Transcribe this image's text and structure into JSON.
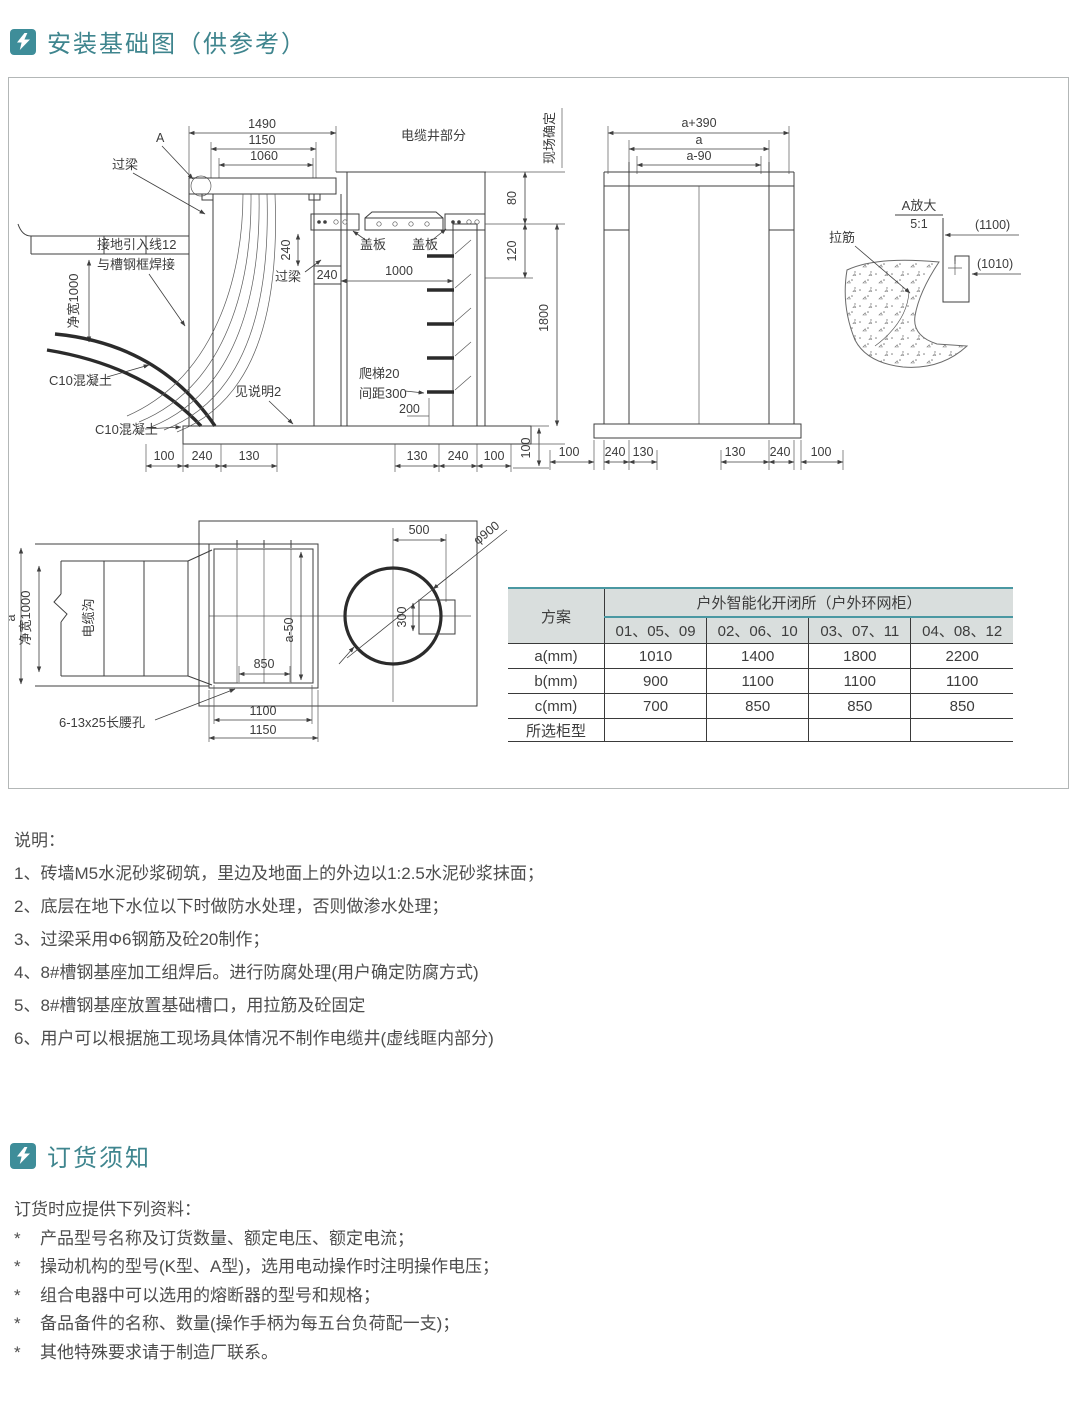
{
  "sections": {
    "install": {
      "title": "安装基础图（供参考）"
    },
    "order": {
      "title": "订货须知"
    }
  },
  "colors": {
    "accent": "#3e8d99",
    "header_text": "#3f858e",
    "table_header_bg": "#d9dedd",
    "table_accent_line": "#4a98a2",
    "drawing_line": "#3f3f3f"
  },
  "drawing": {
    "section": {
      "a": "A",
      "guoliang_top": "过梁",
      "d1490": "1490",
      "d1150": "1150",
      "d1060": "1060",
      "cable_well": "电缆井部分",
      "site_note": "现场确定",
      "d80": "80",
      "d120": "120",
      "d1800": "1800",
      "d100_v": "100",
      "ground_line1": "接地引入线12",
      "ground_line2": "与槽钢框焊接",
      "net_width": "净宽1000",
      "c10_1": "C10混凝土",
      "c10_2": "C10混凝土",
      "see_note2": "见说明2",
      "bottom_left": [
        "100",
        "240",
        "130"
      ],
      "cover1": "盖板",
      "cover2": "盖板",
      "d1000": "1000",
      "d240_v": "240",
      "guoliang_mid": "过梁",
      "d240": "240",
      "ladder1": "爬梯20",
      "ladder2": "间距300",
      "d200": "200",
      "bottom_right": [
        "130",
        "240",
        "100"
      ]
    },
    "front": {
      "a390": "a+390",
      "a": "a",
      "a90": "a-90",
      "bottom": [
        "100",
        "240",
        "130",
        "130",
        "240",
        "100"
      ]
    },
    "detail": {
      "title": "A放大",
      "scale": "5:1",
      "lajin": "拉筋",
      "d1100": "(1100)",
      "d1010": "(1010)"
    },
    "plan": {
      "a": "a",
      "net_width": "净宽1000",
      "trench": "电缆沟",
      "a50": "a-50",
      "d850": "850",
      "d1100": "1100",
      "d1150": "1150",
      "slot": "6-13x25长腰孔",
      "d500": "500",
      "phi900": "φ900",
      "d300": "300"
    }
  },
  "table": {
    "col_plan": "方案",
    "col_group": "户外智能化开闭所（户外环网柜）",
    "subcols": [
      "01、05、09",
      "02、06、10",
      "03、07、11",
      "04、08、12"
    ],
    "rows": [
      {
        "label": "a(mm)",
        "values": [
          "1010",
          "1400",
          "1800",
          "2200"
        ]
      },
      {
        "label": "b(mm)",
        "values": [
          "900",
          "1100",
          "1100",
          "1100"
        ]
      },
      {
        "label": "c(mm)",
        "values": [
          "700",
          "850",
          "850",
          "850"
        ]
      },
      {
        "label": "所选柜型"
      }
    ]
  },
  "notes": {
    "title": "说明：",
    "items": [
      "1、砖墙M5水泥砂浆砌筑，里边及地面上的外边以1:2.5水泥砂浆抹面；",
      "2、底层在地下水位以下时做防水处理，否则做渗水处理；",
      "3、过梁采用Φ6钢筋及砼20制作；",
      "4、8#槽钢基座加工组焊后。进行防腐处理(用户确定防腐方式)",
      "5、8#槽钢基座放置基础槽口，用拉筋及砼固定",
      "6、用户可以根据施工现场具体情况不制作电缆井(虚线眶内部分)"
    ]
  },
  "ordering": {
    "intro": "订货时应提供下列资料：",
    "bullet": "*",
    "items": [
      "产品型号名称及订货数量、额定电压、额定电流；",
      "操动机构的型号(K型、A型)，选用电动操作时注明操作电压；",
      "组合电器中可以选用的熔断器的型号和规格；",
      "备品备件的名称、数量(操作手柄为每五台负荷配一支)；",
      "其他特殊要求请于制造厂联系。"
    ]
  }
}
